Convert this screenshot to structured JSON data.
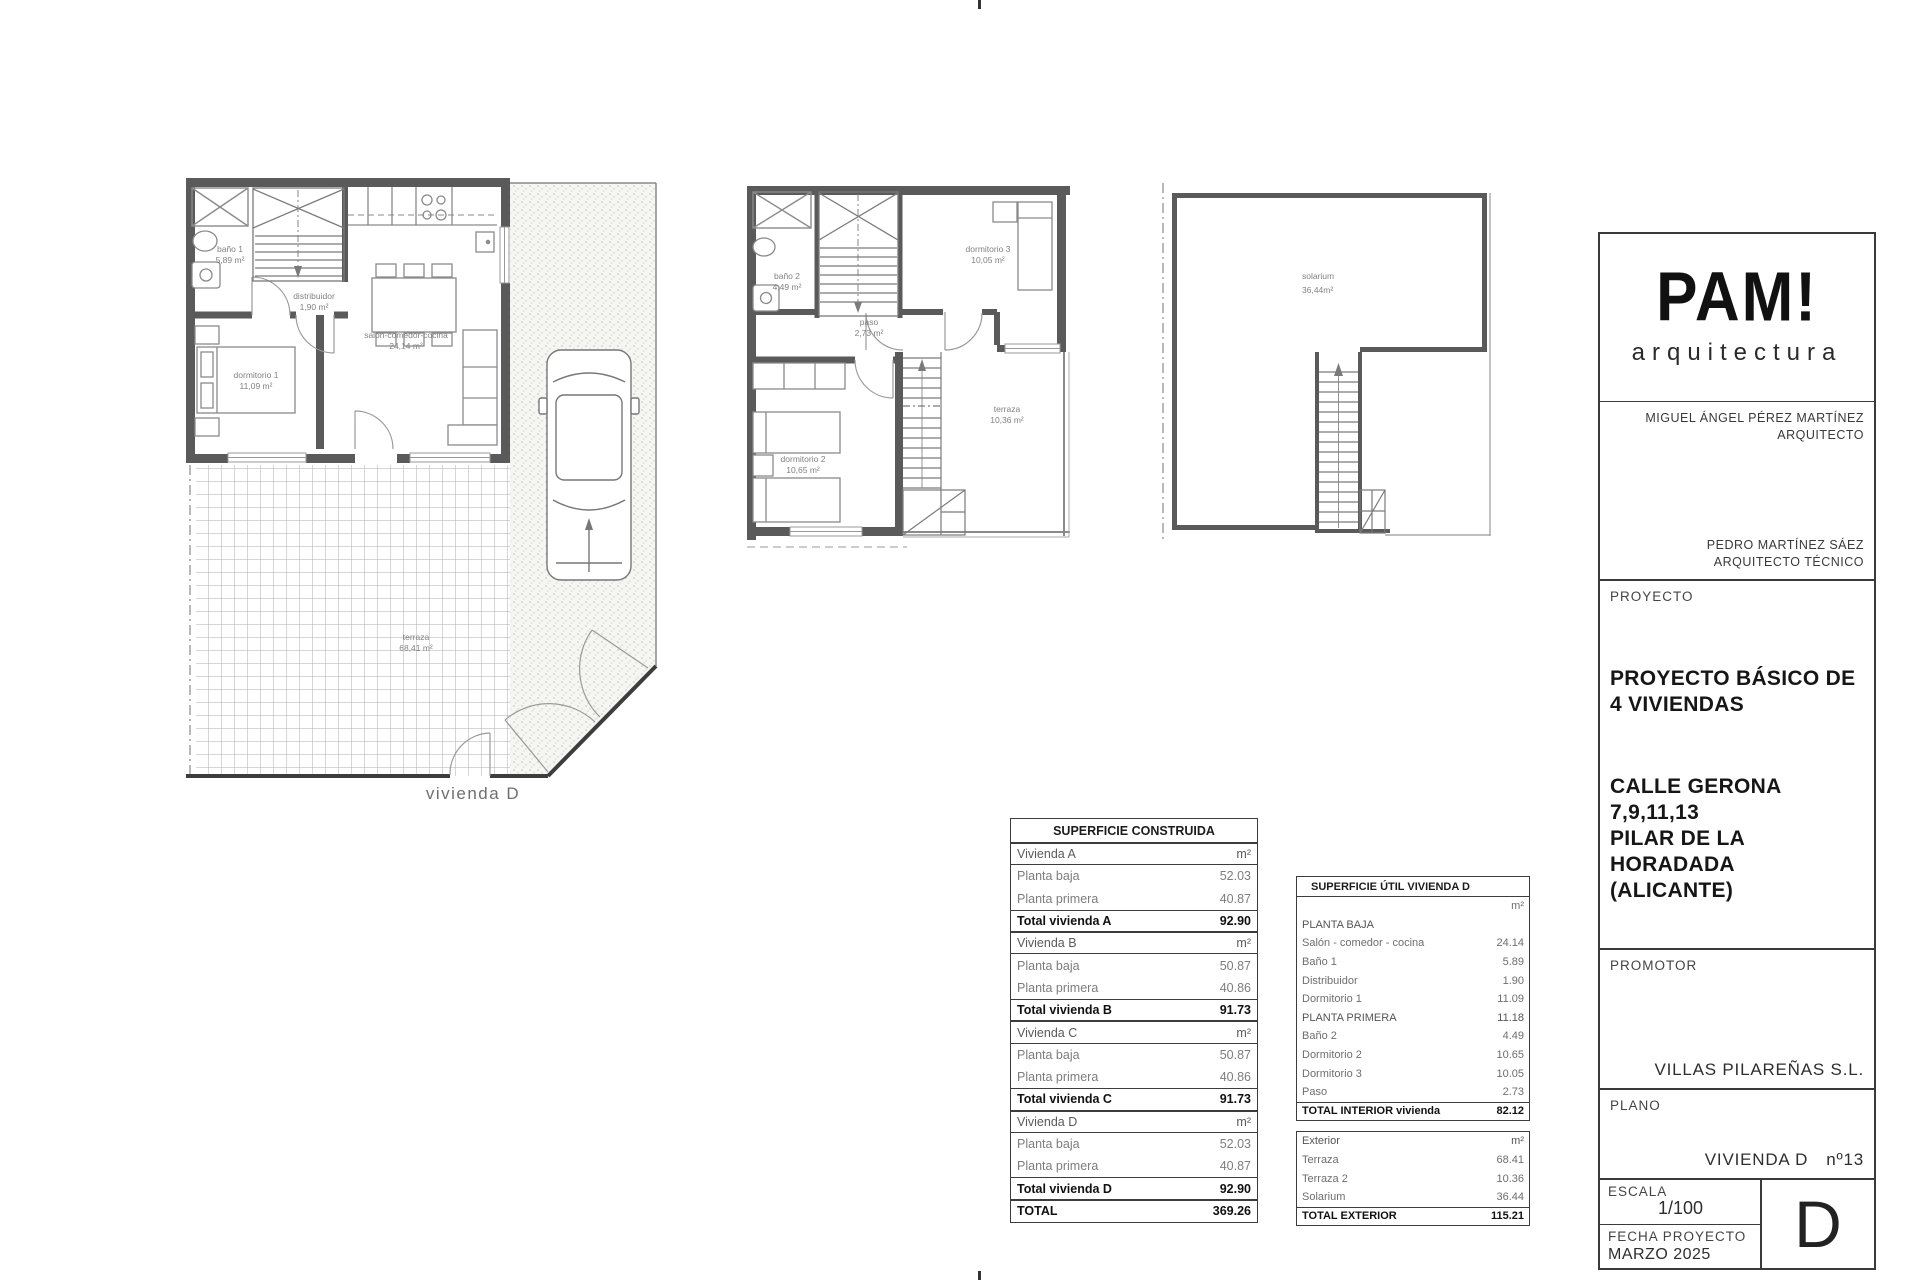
{
  "plans": {
    "ground": {
      "caption": "vivienda D",
      "rooms": {
        "bano1": {
          "name": "baño 1",
          "area": "5,89 m²"
        },
        "distribuidor": {
          "name": "distribuidor",
          "area": "1,90 m²"
        },
        "dormitorio1": {
          "name": "dormitorio 1",
          "area": "11,09 m²"
        },
        "salon": {
          "name": "salón-comedor-cocina",
          "area": "24,14 m²"
        },
        "terraza": {
          "name": "terraza",
          "area": "68,41 m²"
        }
      }
    },
    "first": {
      "rooms": {
        "bano2": {
          "name": "baño 2",
          "area": "4,49 m²"
        },
        "paso": {
          "name": "paso",
          "area": "2,73 m²"
        },
        "dormitorio3": {
          "name": "dormitorio 3",
          "area": "10,05 m²"
        },
        "dormitorio2": {
          "name": "dormitorio 2",
          "area": "10,65 m²"
        },
        "terraza2": {
          "name": "terraza",
          "area": "10,36 m²"
        }
      }
    },
    "solarium": {
      "rooms": {
        "solarium": {
          "name": "solarium",
          "area": "36,44m²"
        }
      }
    }
  },
  "tables": {
    "construida": {
      "title": "SUPERFICIE CONSTRUIDA",
      "rows": [
        {
          "label": "Vivienda A",
          "value": "m²"
        },
        {
          "label": "Planta baja",
          "value": "52.03"
        },
        {
          "label": "Planta primera",
          "value": "40.87"
        },
        {
          "label": "Total vivienda A",
          "value": "92.90"
        },
        {
          "label": "Vivienda B",
          "value": "m²"
        },
        {
          "label": "Planta baja",
          "value": "50.87"
        },
        {
          "label": "Planta primera",
          "value": "40.86"
        },
        {
          "label": "Total vivienda B",
          "value": "91.73"
        },
        {
          "label": "Vivienda C",
          "value": "m²"
        },
        {
          "label": "Planta baja",
          "value": "50.87"
        },
        {
          "label": "Planta primera",
          "value": "40.86"
        },
        {
          "label": "Total vivienda C",
          "value": "91.73"
        },
        {
          "label": "Vivienda D",
          "value": "m²"
        },
        {
          "label": "Planta baja",
          "value": "52.03"
        },
        {
          "label": "Planta primera",
          "value": "40.87"
        },
        {
          "label": "Total vivienda D",
          "value": "92.90"
        },
        {
          "label": "TOTAL",
          "value": "369.26"
        }
      ]
    },
    "util": {
      "title": "SUPERFICIE ÚTIL VIVIENDA D",
      "interior_rows": [
        {
          "label": "",
          "value": "m²"
        },
        {
          "label": "PLANTA BAJA",
          "value": ""
        },
        {
          "label": "Salón - comedor - cocina",
          "value": "24.14"
        },
        {
          "label": "Baño 1",
          "value": "5.89"
        },
        {
          "label": "Distribuidor",
          "value": "1.90"
        },
        {
          "label": "Dormitorio 1",
          "value": "11.09"
        },
        {
          "label": "PLANTA PRIMERA",
          "value": "11.18"
        },
        {
          "label": "Baño 2",
          "value": "4.49"
        },
        {
          "label": "Dormitorio 2",
          "value": "10.65"
        },
        {
          "label": "Dormitorio 3",
          "value": "10.05"
        },
        {
          "label": "Paso",
          "value": "2.73"
        },
        {
          "label": "TOTAL INTERIOR vivienda",
          "value": "82.12"
        }
      ],
      "exterior_rows": [
        {
          "label": "Exterior",
          "value": "m²"
        },
        {
          "label": "Terraza",
          "value": "68.41"
        },
        {
          "label": "Terraza 2",
          "value": "10.36"
        },
        {
          "label": "Solarium",
          "value": "36.44"
        },
        {
          "label": "TOTAL EXTERIOR",
          "value": "115.21"
        }
      ]
    }
  },
  "titleblock": {
    "logo": {
      "title": "PAM!",
      "subtitle": "arquitectura"
    },
    "architect": {
      "name": "MIGUEL ÁNGEL PÉREZ MARTÍNEZ",
      "role": "ARQUITECTO"
    },
    "technical": {
      "name": "PEDRO MARTÍNEZ SÁEZ",
      "role": "ARQUITECTO TÉCNICO"
    },
    "proyecto": {
      "label": "PROYECTO",
      "title_line1": "PROYECTO BÁSICO DE",
      "title_line2": "4 VIVIENDAS",
      "address_line1": "CALLE GERONA",
      "address_line2": "7,9,11,13",
      "address_line3": "PILAR DE LA HORADADA",
      "address_line4": "(ALICANTE)"
    },
    "promotor": {
      "label": "PROMOTOR",
      "name": "VILLAS PILAREÑAS S.L."
    },
    "plano": {
      "label": "PLANO",
      "name": "VIVIENDA D",
      "number": "nº13"
    },
    "escala": {
      "label": "ESCALA",
      "value": "1/100"
    },
    "fecha": {
      "label": "FECHA PROYECTO",
      "value": "MARZO 2025"
    },
    "sheet": {
      "letter": "D"
    }
  }
}
